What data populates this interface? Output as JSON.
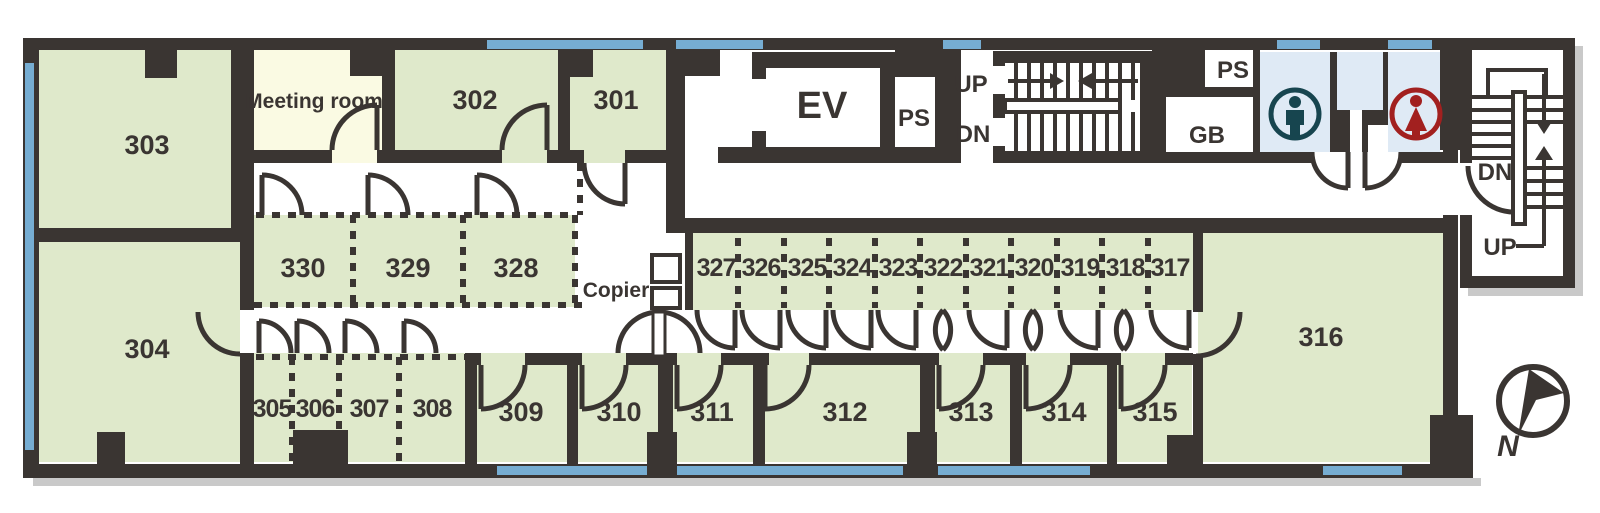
{
  "rooms": {
    "301": "301",
    "302": "302",
    "303": "303",
    "304": "304",
    "305": "305",
    "306": "306",
    "307": "307",
    "308": "308",
    "309": "309",
    "310": "310",
    "311": "311",
    "312": "312",
    "313": "313",
    "314": "314",
    "315": "315",
    "316": "316",
    "317": "317",
    "318": "318",
    "319": "319",
    "320": "320",
    "321": "321",
    "322": "322",
    "323": "323",
    "324": "324",
    "325": "325",
    "326": "326",
    "327": "327",
    "328": "328",
    "329": "329",
    "330": "330"
  },
  "labels": {
    "meeting_room": "Meeting room",
    "elevator": "EV",
    "pipe_shaft": "PS",
    "garbage": "GB",
    "up": "UP",
    "down": "DN",
    "copier": "Copier",
    "compass_north": "N"
  },
  "colors": {
    "wall": "#3a3532",
    "room_green": "#dfe9cb",
    "meeting_ivory": "#fafae3",
    "toilet_blue": "#dfeaf5",
    "window_blue": "#76add2",
    "male_icon": "#17454f",
    "female_icon": "#a2201f",
    "shadow": "#c9c9c9",
    "text": "#3a3532"
  }
}
